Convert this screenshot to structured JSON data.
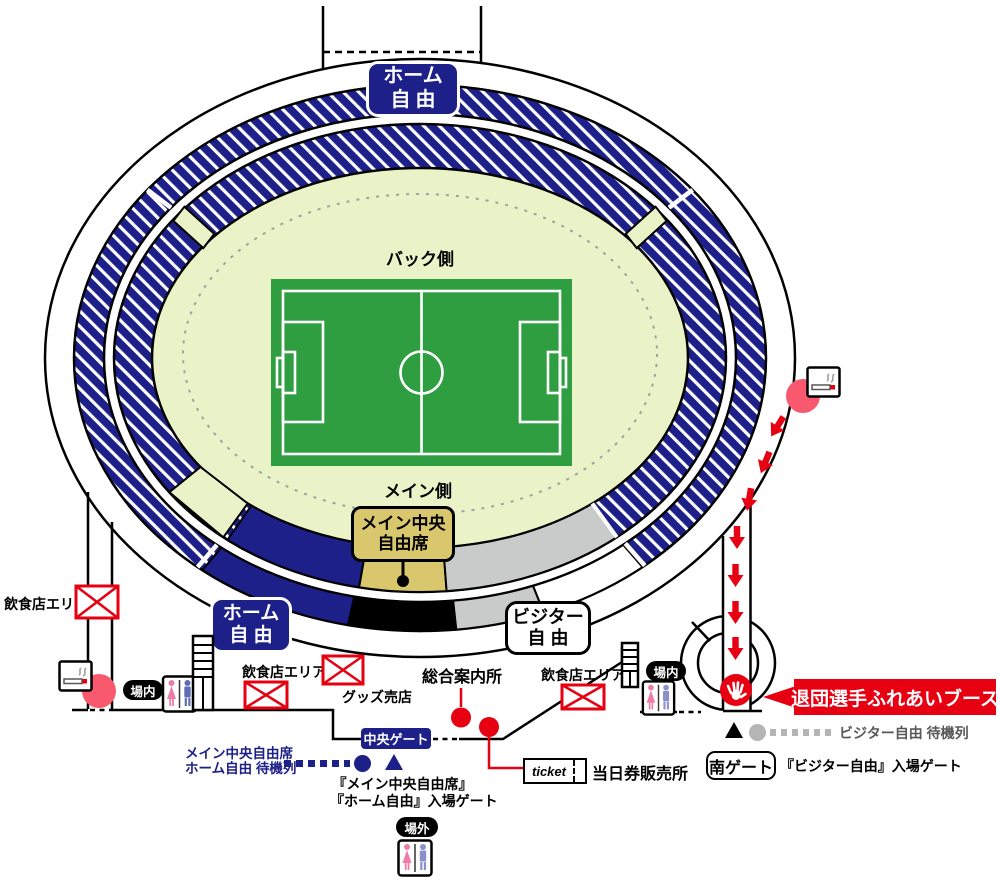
{
  "stadium": {
    "areas": {
      "home_free_top": {
        "line1": "ホーム",
        "line2": "自由"
      },
      "back_side": "バック側",
      "main_side": "メイン側",
      "main_center_free": {
        "line1": "メイン中央",
        "line2": "自由席"
      },
      "home_free": {
        "line1": "ホーム",
        "line2": "自 由"
      },
      "visitor_free": {
        "line1": "ビジター",
        "line2": "自 由"
      }
    }
  },
  "facilities": {
    "food_area": "飲食店エリア",
    "goods_shop": "グッズ売店",
    "info_center": "総合案内所",
    "ticket_logo": "ticket",
    "ticket_office": "当日券販売所"
  },
  "gates": {
    "central": "中央ゲート",
    "south": "南ゲート",
    "inside": "場内",
    "outside": "場外",
    "main_gate_note_line1": "『メイン中央自由席』",
    "main_gate_note_line2": "『ホーム自由』入場ゲート",
    "south_gate_note": "『ビジター自由』入場ゲート"
  },
  "queues": {
    "home_line1": "メイン中央自由席",
    "home_line2": "ホーム自由 待機列",
    "visitor": "ビジター自由 待機列"
  },
  "booth": {
    "farewell": "退団選手ふれあいブース"
  },
  "icons": {
    "food_stall": "food-stall-icon",
    "smoking": "smoking-area-icon",
    "restroom": "restroom-icon",
    "stairs": "stairs-icon",
    "hand": "hand-greeting-icon"
  },
  "colors": {
    "navy": "#1d2088",
    "red": "#e60012",
    "pink": "#f8596e",
    "tan": "#d8c76d",
    "pitch_green": "#2f9e41",
    "field_light": "#e9f3c7",
    "gray_band": "#c9caca",
    "queue_gray": "#b5b5b6",
    "queue_text_gray": "#595757"
  }
}
